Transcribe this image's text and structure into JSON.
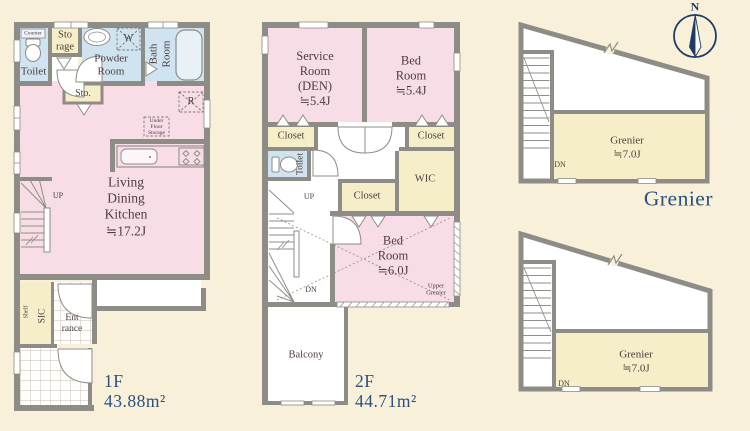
{
  "colors": {
    "background": "#f8f0d9",
    "room_pink": "#f8dce6",
    "room_blue": "#cfe3f0",
    "closet_cream": "#f6eec9",
    "wall_gray": "#8d8c86",
    "label_navy": "#2a5080",
    "text_brown": "#4f3d3d"
  },
  "compass": {
    "north_label": "N"
  },
  "floor1": {
    "floor_label": "1F",
    "area_label": "43.88m²",
    "counter": "Counter",
    "toilet": "Toilet",
    "storage": "Sto\nrage",
    "powder_room": "Powder\nRoom",
    "bath_room": "Bath\nRoom",
    "washing_machine": "W",
    "storage_closet": "Sto.",
    "refrigerator": "R",
    "under_floor_storage": "Under\nFloor\nStorage",
    "ldk": "Living\nDining\nKitchen\n≒17.2J",
    "up": "UP",
    "shelf": "Shelf",
    "sic": "SIC",
    "entrance": "Ent\nrance"
  },
  "floor2": {
    "floor_label": "2F",
    "area_label": "44.71m²",
    "service_room": "Service\nRoom\n(DEN)\n≒5.4J",
    "bed_room_small": "Bed\nRoom\n≒5.4J",
    "closet_left": "Closet",
    "closet_right": "Closet",
    "closet_middle": "Closet",
    "toilet": "Toilet",
    "wic": "WIC",
    "bed_room_large": "Bed\nRoom\n≒6.0J",
    "upper_grenier": "Upper\nGrenier",
    "balcony": "Balcony",
    "up": "UP",
    "dn": "DN"
  },
  "grenier": {
    "section_label": "Grenier",
    "attic_top": "Grenier\n≒7.0J",
    "attic_bottom": "Grenier\n≒7.0J",
    "dn_top": "DN",
    "dn_bottom": "DN"
  }
}
